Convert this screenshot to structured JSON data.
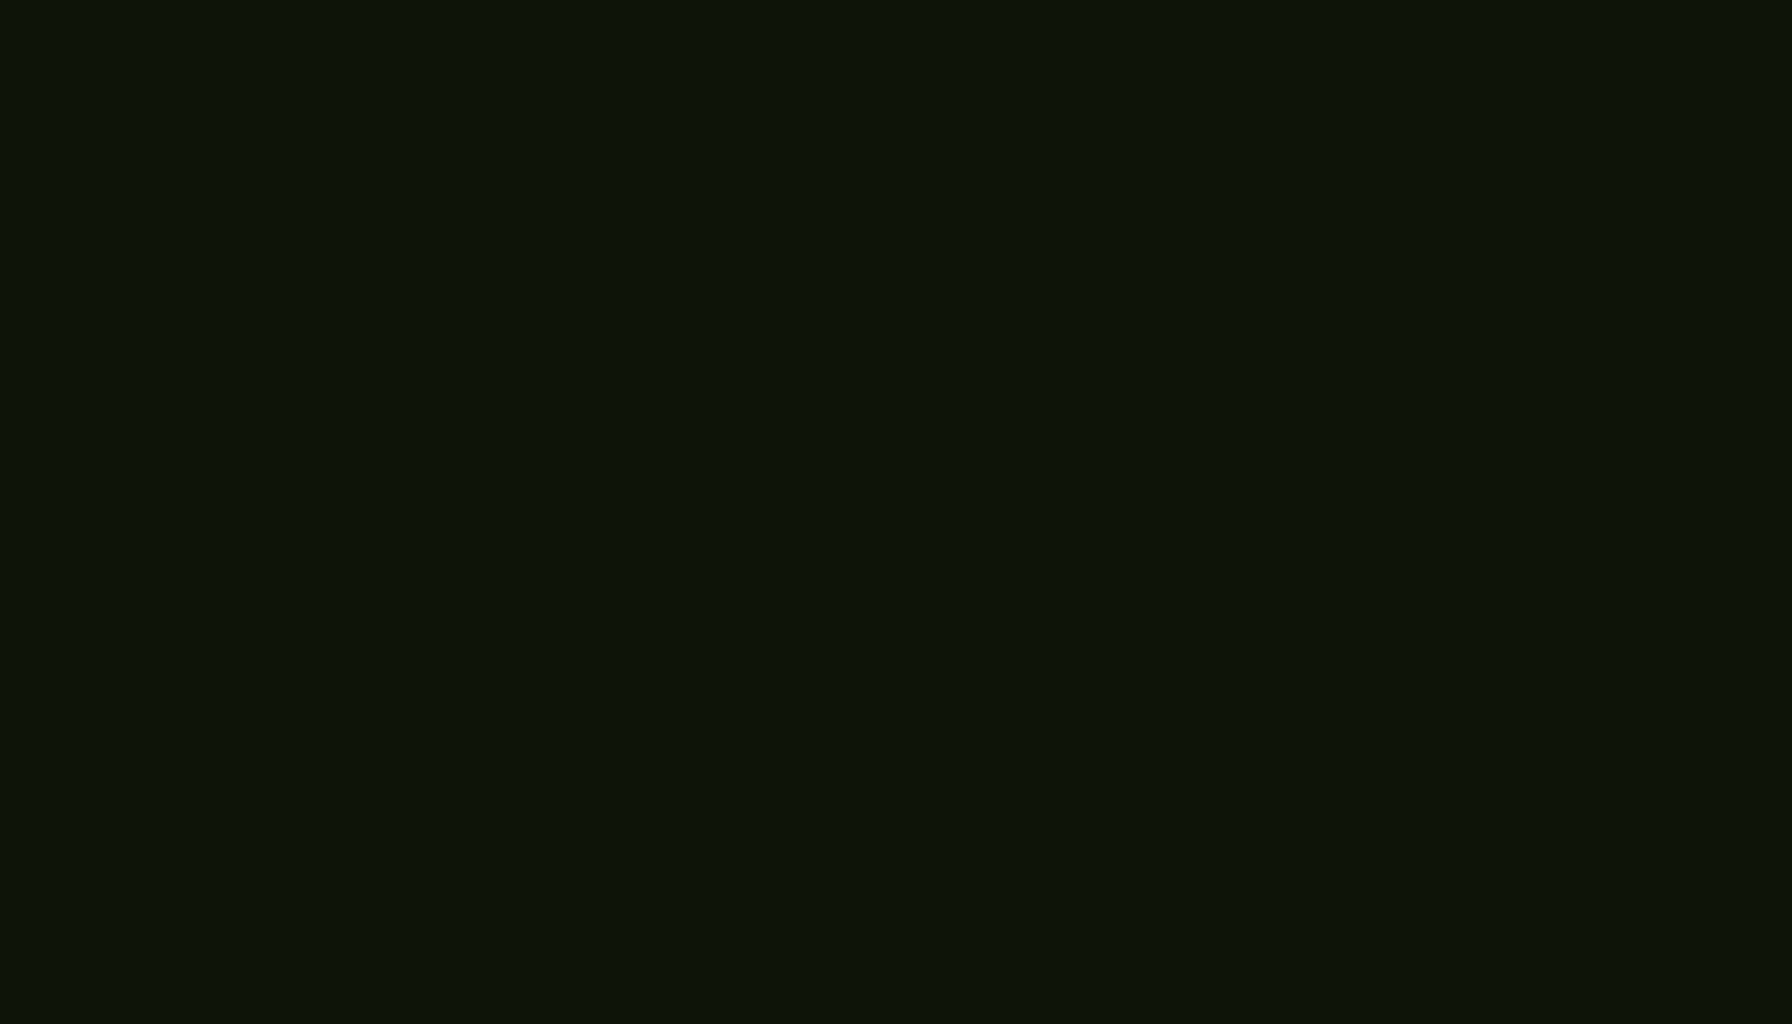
{
  "image": {
    "kind": "architectural-aerial-rendering",
    "subject": "Tulum-style boutique condo building surrounded by dense jungle",
    "view": "oblique drone view",
    "width_px": 1792,
    "height_px": 1024
  },
  "palette": {
    "jungle_base": "#1f2f18",
    "jungle_dark": "#24381c",
    "jungle_mid": "#2f4a24",
    "jungle_green": "#3c5c2c",
    "jungle_light": "#4f7233",
    "jungle_sun": "#648a3c",
    "jungle_bright": "#8fae56",
    "leaf_glint": "#c9d98e",
    "accent_orange": "#b06a28",
    "accent_rust": "#8a4f1e",
    "sage": "#9cb181",
    "sage_light": "#c2d2a6",
    "roof_cream": "#e7dfcc",
    "roof_light": "#f3eddd",
    "parapet_white": "#f7f2e5",
    "wall_shadow": "#c7bca4",
    "facade_tan": "#d8cdb4",
    "thatch_light": "#ead9ad",
    "thatch_mid": "#d3b679",
    "thatch_dark": "#a9854a",
    "wood_slat": "#7b5134",
    "wood_gate": "#8a5f3e",
    "pergola_wood": "#8a5a3a",
    "pergola_dark": "#6f4730",
    "pergola_light": "#a97a50",
    "stone_light": "#dbd1b8",
    "stone_line": "#b7ab8e",
    "paver_green": "#8a9a52",
    "paver_white": "#e9ecd4",
    "road_gray": "#a7b0b2",
    "road_tan": "#c9bfa9",
    "road_joint": "#6e787a",
    "grass_lawn": "#a3b558",
    "terracotta": "#a05c32",
    "car_black": "#1b1d1e",
    "car_gray": "#b3aca1",
    "car_white": "#e9eae6"
  },
  "scene": {
    "jungle": {
      "coverage": "dense tropical canopy filling every edge of the frame",
      "accents": [
        "orange flowering shrubs",
        "sunlit light-green treetops",
        "palm clusters"
      ],
      "seed": 7
    },
    "building": {
      "name": "white stucco condo complex",
      "floors_visible": 3,
      "rooftop_palapas": 4,
      "rooftop_features": [
        "thatched palapa shades",
        "roof terraces with table and chairs",
        "sun loungers",
        "stone benches",
        "dark roof vents"
      ],
      "facade_features": [
        "hanging balcony vines",
        "wood slat screens",
        "stone-clad tower",
        "rubble stone base walls",
        "wooden patio gates"
      ],
      "adjacent_structure": "terracotta tile roof outbuilding"
    },
    "pergola": {
      "name": "timber carport pergola",
      "material": "brown wood beam lattice",
      "posts": 6,
      "covers": "parking bay paved with green grass-grid pavers"
    },
    "vehicles": [
      {
        "type": "sedan",
        "color": "#1b1d1e"
      },
      {
        "type": "jeep-suv",
        "color": "#b3aca1"
      },
      {
        "type": "compact-car",
        "color": "#e9eae6"
      },
      {
        "type": "compact-car",
        "color": "#e9eae6"
      }
    ],
    "road": {
      "surface": "gray concrete slab road",
      "features": [
        "expansion joints",
        "sunlit tan curb band",
        "dark seams",
        "tree shadows"
      ]
    },
    "landscape": [
      "lawn at the road bend",
      "round planter with tree",
      "grass mound at driveway",
      "planting strip with palms along the facade"
    ]
  }
}
